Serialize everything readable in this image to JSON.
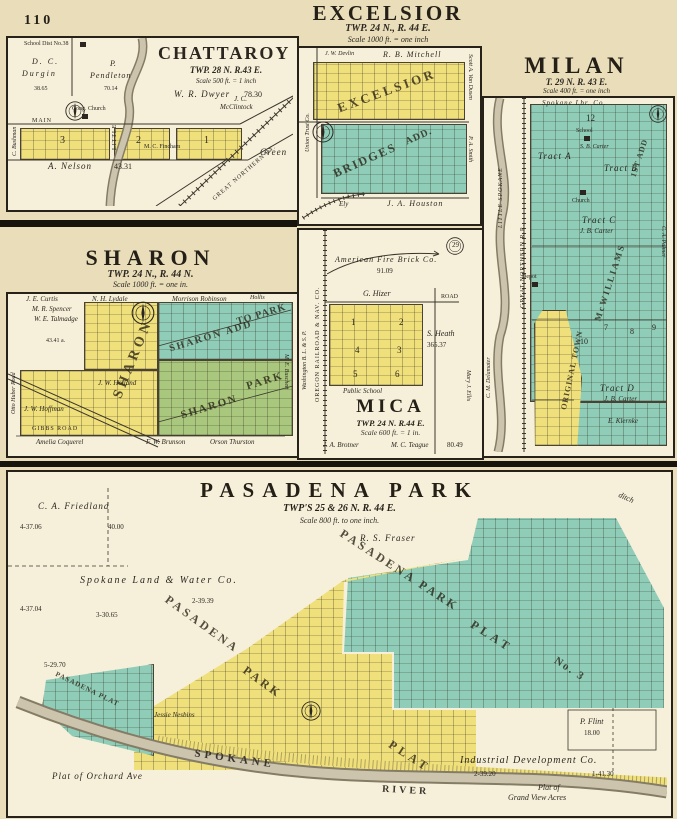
{
  "page": {
    "number": "110"
  },
  "colors": {
    "page_bg": "#e9ddba",
    "panel_bg": "#f6f0da",
    "plat_yellow": "#f0e07c",
    "plat_teal": "#8fcdb9",
    "plat_green": "#a9c87e",
    "river_gray": "#cdc4ae",
    "ink": "#2b2720"
  },
  "chattaroy": {
    "title": "CHATTAROY",
    "township": "TWP. 28 N. R.43 E.",
    "scale": "Scale 500 ft. = 1 inch",
    "labels": {
      "school": "School Dist No.38",
      "durgin_1": "D. C.",
      "durgin_2": "Durgin",
      "durgin_acres": "38.65",
      "pendleton_1": "P.",
      "pendleton_2": "Pendleton",
      "pendleton_acres": "70.14",
      "dwyer": "W. R. Dwyer",
      "dwyer_acres": "78.30",
      "church": "Cong. Church",
      "main": "MAIN",
      "creek": "LITTLE",
      "block3": "3",
      "block2": "2",
      "block1": "1",
      "mcclintock_1": "J. C.",
      "mcclintock_2": "McClintock",
      "fincham": "M. C. Fincham",
      "nelson": "A. Nelson",
      "nelson_acres": "43.31",
      "green": "Green",
      "railroad": "GREAT NORTHERN RY.",
      "bushman": "C. Bushman"
    }
  },
  "excelsior": {
    "title": "EXCELSIOR",
    "township": "TWP. 24 N., R. 44 E.",
    "scale": "Scale 1000 ft. = one inch",
    "labels": {
      "devlin": "J. W. Devlin",
      "mitchell": "R. B. Mitchell",
      "plat": "EXCELSIOR",
      "bridges": "BRIDGES",
      "add": "ADD.",
      "ely": "Ely",
      "houston": "J. A. Houston",
      "union_trust": "Union Trust Co.",
      "van_dusen": "Scott A. Van Dusen",
      "smith": "P. A. Smith"
    }
  },
  "milan": {
    "title": "MILAN",
    "township": "T. 29 N. R. 43 E.",
    "scale": "Scale 400 ft. = one inch",
    "labels": {
      "lumber": "Spokane Lbr. Co.",
      "section": "12",
      "school": "School",
      "carter_sb": "S. B. Carter",
      "tract_a": "Tract A",
      "tract_b": "Tract B",
      "tract_c": "Tract C",
      "tract_d": "Tract D",
      "carter_jb": "J. B. Carter",
      "carter_jb2": "J. B. Carter",
      "church": "Church",
      "mcwilliams": "McWILLIAMS",
      "first_add": "1ST ADD",
      "original_town": "ORIGINAL TOWN",
      "depot": "Depot",
      "b7": "7",
      "b8": "8",
      "b9": "9",
      "b10": "10",
      "palmer": "C. A. Palmer",
      "klernke": "E. Klernke",
      "delamater": "C. M. Delamater",
      "railroad": "GREAT NORTHERN R.R.",
      "river": "LITTLE SPOKANE"
    }
  },
  "sharon": {
    "title": "SHARON",
    "township": "TWP. 24 N., R. 44 N.",
    "scale": "Scale 1000 ft. = one in.",
    "labels": {
      "curtis": "J. E. Curtis",
      "lydale": "N. H. Lydale",
      "robinson": "Morrison Robinson",
      "hollis": "Hollis",
      "spencer": "M. R. Spencer",
      "talmadge": "W. E. Talmadge",
      "acres": "43.41 a.",
      "plat": "SHARON",
      "add1": "SHARON ADD",
      "add2": "TO PARK",
      "park1": "SHARON",
      "park2": "PARK",
      "holland": "J. W. Holland",
      "hoffman": "J. W. Hoffman",
      "gibbs": "GIBBS ROAD",
      "coquerel": "Amelia Coquerel",
      "brunson": "F. W. Brunson",
      "thurston": "Orson Thurston",
      "huber": "Otto Huber Road",
      "buschett": "M. E. Buschett"
    }
  },
  "mica": {
    "title": "MICA",
    "township": "TWP. 24 N. R.44 E.",
    "scale": "Scale 600 ft. = 1 in.",
    "labels": {
      "fire_brick": "American Fire Brick Co.",
      "fire_brick_acres": "91.09",
      "hizer": "G. Hizer",
      "road": "ROAD",
      "b1": "1",
      "b2": "2",
      "b3": "3",
      "b4": "4",
      "b5": "5",
      "b6": "6",
      "heath": "S. Heath",
      "heath_acres": "365.37",
      "public_school": "Public School",
      "brotner": "J. A. Brotner",
      "teague": "M. C. Teague",
      "teague_acres": "80.49",
      "oregon_rr": "OREGON RAILROAD & NAV. CO.",
      "washington": "Washington B. L. & S. P.",
      "ellis": "Mary J. Ellis",
      "seal": "29"
    }
  },
  "pasadena": {
    "title": "PASADENA PARK",
    "township": "TWP'S 25 & 26 N. R. 44 E.",
    "scale": "Scale 800 ft. to one inch.",
    "labels": {
      "friedland": "C. A. Friedland",
      "a1": "4-37.06",
      "a2": "40.00",
      "spokane_land": "Spokane Land & Water Co.",
      "a3": "2-39.39",
      "a4": "3-30.65",
      "a5": "4-37.04",
      "a6": "5-29.70",
      "fraser": "R. S. Fraser",
      "ditch": "ditch",
      "teal_name": "PASADENA  PARK",
      "teal_plat": "PLAT",
      "teal_no": "No. 3",
      "yellow_name": "PASADENA",
      "yellow_park": "PARK",
      "yellow_plat": "PLAT",
      "wedge": "PASADENA PLAT",
      "nesbins": "Jessie Nesbins",
      "spokane": "SPOKANE",
      "river": "RIVER",
      "orchard": "Plat of Orchard Ave",
      "industrial": "Industrial Development Co.",
      "a7": "2-39.20",
      "a8": "1-41.30",
      "flint": "P. Flint",
      "flint_acres": "18.00",
      "grandview1": "Plat of",
      "grandview2": "Grand View Acres"
    }
  }
}
